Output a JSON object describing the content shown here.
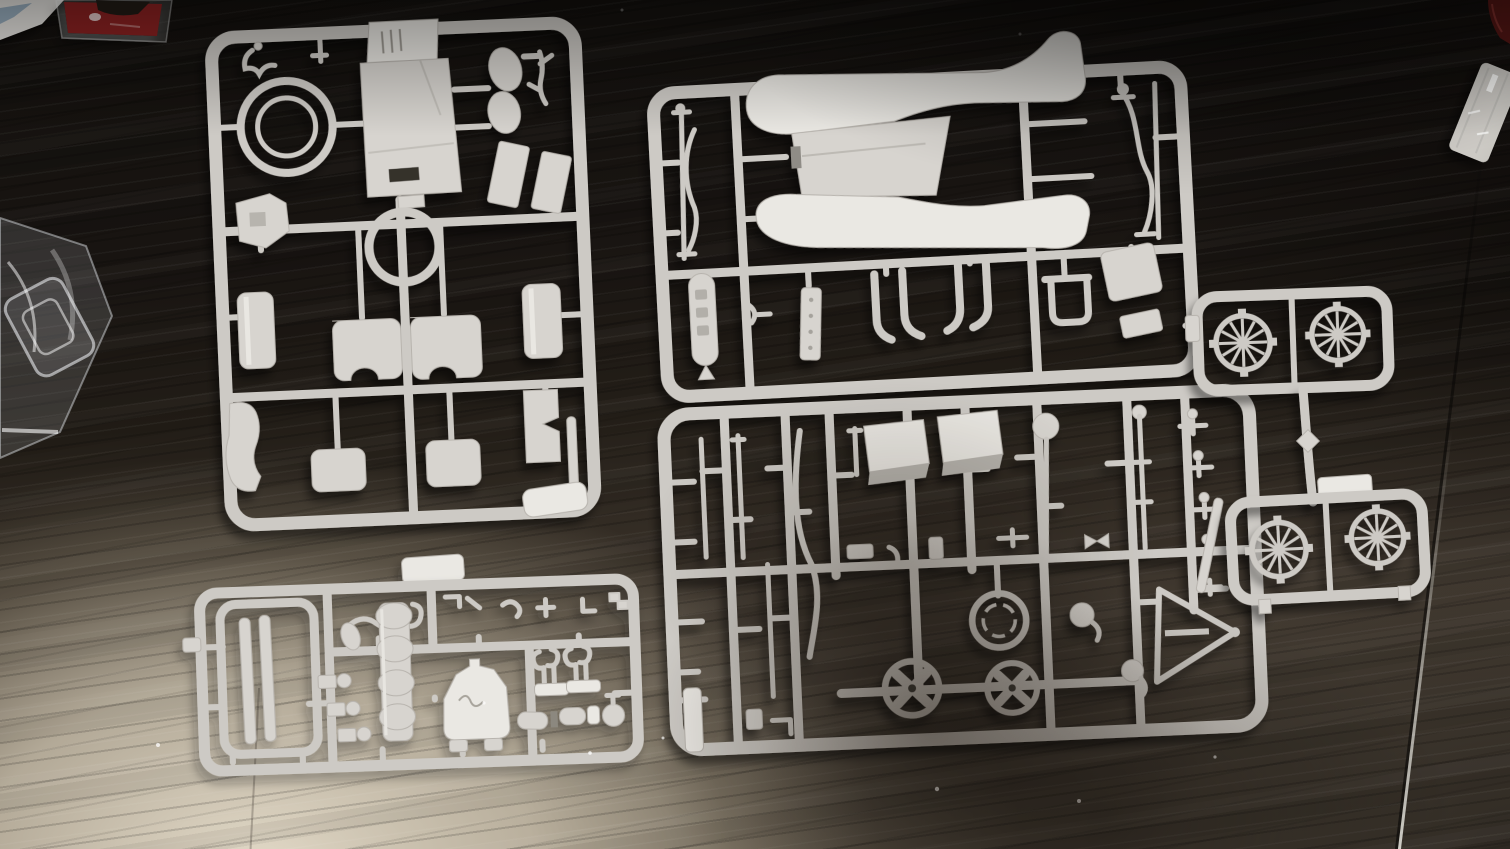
{
  "palette": {
    "plastic": "#cdcac5",
    "plastic-part": "#d7d4cf",
    "plastic-bright": "#eae8e3",
    "plastic-edge": "#b7b3ad",
    "plastic-shade": "#a8a49d",
    "table-dark": "#14110e",
    "table-mid": "#332c24",
    "table-warm": "#4e463b",
    "flash-light": "#e2d9c7",
    "bag-film": "#e8ecee",
    "red-packet": "#8e2120",
    "dark-red-object": "#581715",
    "glass-object": "#d6d4cf",
    "box-white": "#eceae6",
    "box-blue": "#9db3c4"
  },
  "scene": {
    "objects": [
      {
        "name": "sprue-body-panels",
        "contents": "car body with louvered hood, tire ring, oval seats, boxes, roof panels, seat cushions, fenders"
      },
      {
        "name": "sprue-fenders-chassis",
        "contents": "one-piece fender and running-board unit, front and rear axles, frame horns, floor boards"
      },
      {
        "name": "sprue-chassis-small-parts",
        "contents": "rods, levers, seat boxes, brake drum ring, two x-spoke hubs, horns, windshield a-frame"
      },
      {
        "name": "sprue-engine-parts",
        "contents": "radiator shell, engine cylinder stack, carburetors, fuel tank with script, exhaust, manifolds"
      },
      {
        "name": "wheel-sprue-top",
        "contents": "two 12-spoke wheels"
      },
      {
        "name": "wheel-sprue-bottom",
        "contents": "two 12-spoke wheels"
      },
      {
        "name": "clear-parts-bag",
        "contents": "vacuum-formed clear windshield blister in polybag"
      },
      {
        "name": "red-packet",
        "contents": "red item inside glossy polybag, cropped at top edge"
      },
      {
        "name": "white-box-corner",
        "contents": "white box corner with blue print, cropped top-left"
      },
      {
        "name": "dark-red-object",
        "contents": "dark red item cropped at top-right corner"
      },
      {
        "name": "glass-object",
        "contents": "faceted clear glass corner at right edge"
      },
      {
        "name": "photographer-shadow",
        "contents": "soft cast shadow over lower-centre sprue"
      }
    ],
    "wheel_spoke_count": 12,
    "wheel_count": 4,
    "sprue_count": 6
  }
}
